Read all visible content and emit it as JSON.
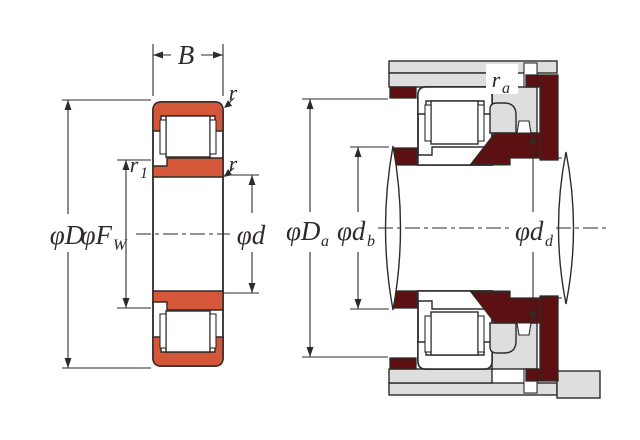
{
  "diagram": {
    "type": "bearing-dimension-drawing",
    "views": {
      "left": "bearing cross-section",
      "right": "mounted bearing with shaft and housing"
    }
  },
  "labels": {
    "width": "B",
    "outer_diameter": "φD",
    "raceway": {
      "main": "φF",
      "sub": "W"
    },
    "bore": {
      "main": "φd",
      "sub": ""
    },
    "chamfer_outer": "r",
    "chamfer_inner_face": "r",
    "chamfer_rib": {
      "main": "r",
      "sub": "1"
    },
    "housing_abutment": {
      "main": "φD",
      "sub": "a"
    },
    "shaft_abutment": {
      "main": "φd",
      "sub": "b"
    },
    "collar_abutment": {
      "main": "φd",
      "sub": "d"
    },
    "mount_fillet": {
      "main": "r",
      "sub": "a"
    }
  },
  "colors": {
    "bearing_ring": "#D4573A",
    "abutment": "#5C1012",
    "housing": "#DEDEDE",
    "line": "#2E2A29",
    "background": "#FFFFFF"
  }
}
